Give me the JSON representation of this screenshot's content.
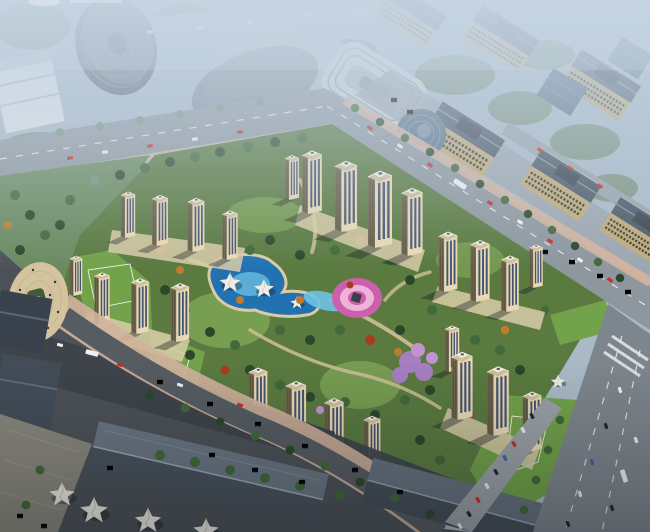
{
  "scene": {
    "type": "architectural-aerial-rendering",
    "description": "Hazy daytime bird's-eye rendering of a residential compound: cream apartment towers ring a landscaped garden with a blue swimming pool, white shade canopies, pink flower garden and lavender grove; tree-lined boulevards separate it from grid-windowed commercial blocks to the northeast, a curved glass office tower at top-left, long blue-roofed retail halls, white event tents and plazas along the darker bottom streets, and a multi-lane arterial road on the right.",
    "time_of_day": "hazy daylight",
    "camera": "high-angle bird's eye",
    "watermark": "faint cropped watermark sliver at top edge (illegible)"
  },
  "elements": {
    "residential_towers": 25,
    "ne_commercial_blocks": 6,
    "glass_office_buildings": 3,
    "curved_glass_tower": 1,
    "swimming_pool": 1,
    "pool_canopies": 3,
    "entrance_canopy": 1,
    "event_tents": 4,
    "flower_garden": 1,
    "lavender_grove": 1,
    "circular_plaza": 1,
    "fountain": 1,
    "south_retail_roofs": 2
  },
  "palette": {
    "haze_ground": "#a9b9c6",
    "hazy_green": "#7d947f",
    "upper_road": "#b4bdc4",
    "boulevard": "#8e979e",
    "arterial": "#7e868d",
    "dark_street": "#3e444a",
    "mid_street": "#555c62",
    "promenade_pink": "#d2b29c",
    "site_green": "#5a7a40",
    "lawn": "#83ab58",
    "podium_green": "#72a24a",
    "tree_dark": "#2c482a",
    "tree_mid": "#41693a",
    "hazy_tree": "#74917c",
    "tree_autumn": "#c07c2c",
    "tree_red": "#a63c22",
    "tree_purple": "#c493cf",
    "pool_deep": "#2272b2",
    "pool_light": "#6ec2e2",
    "flower_pink": "#cc5fae",
    "flower_pink_light": "#efb3d9",
    "lavender": "#a47fc2",
    "tower_face": "#ead9b5",
    "tower_side": "#6e6550",
    "tower_window": "#35486a",
    "tower_roof": "#cdbf98",
    "tower_cap": "#f2eee2",
    "commercial_roof": "#4b5866",
    "commercial_face": "#c2ab78",
    "plaza_beige": "#d3c49e",
    "tent_white": "#eeece4",
    "glass_blue": "#5d7388",
    "white_building": "#dfe5e8",
    "car_red": "#c52f27",
    "car_white": "#eef0f2",
    "car_dark": "#23282e",
    "car_blue": "#3a66a8",
    "stall_red": "#bf2f2c",
    "path_tan": "#cdc096",
    "haze_tint": "#c6d5e4"
  }
}
